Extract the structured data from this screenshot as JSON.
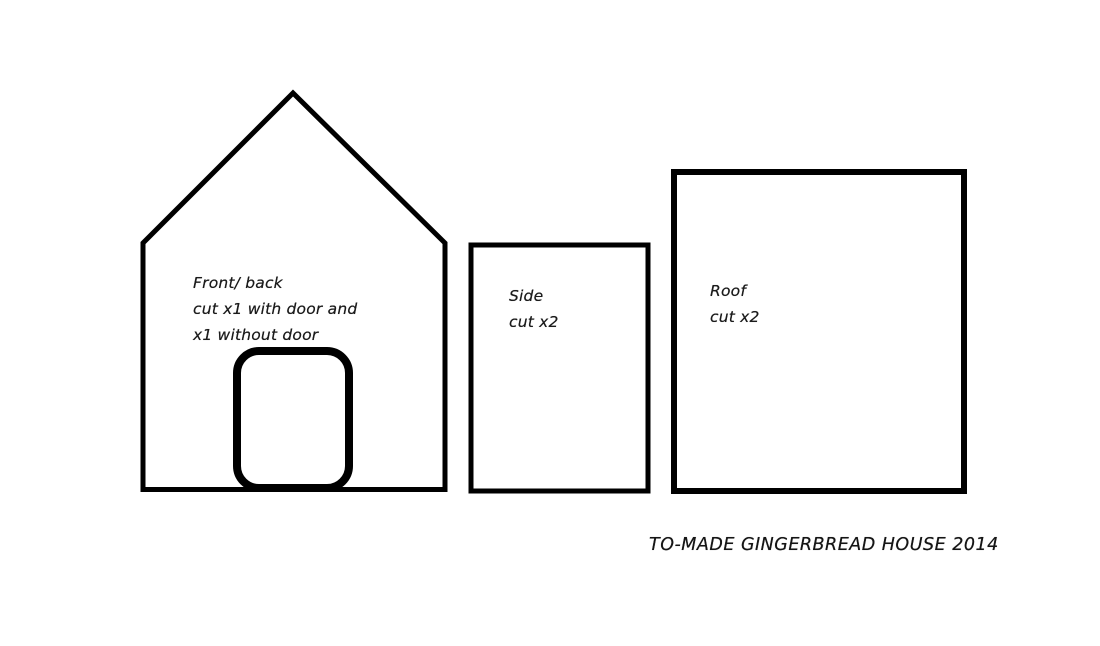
{
  "pieces": {
    "front_back": {
      "lines": [
        "Front/ back",
        "cut x1 with door and",
        "x1 without door"
      ]
    },
    "side": {
      "lines": [
        "Side",
        "cut x2"
      ]
    },
    "roof": {
      "lines": [
        "Roof",
        "cut x2"
      ]
    }
  },
  "footer": {
    "title": "TO-MADE GINGERBREAD HOUSE 2014"
  },
  "colors": {
    "outline": "#000000",
    "background": "#ffffff",
    "text": "#1b1b1b"
  }
}
